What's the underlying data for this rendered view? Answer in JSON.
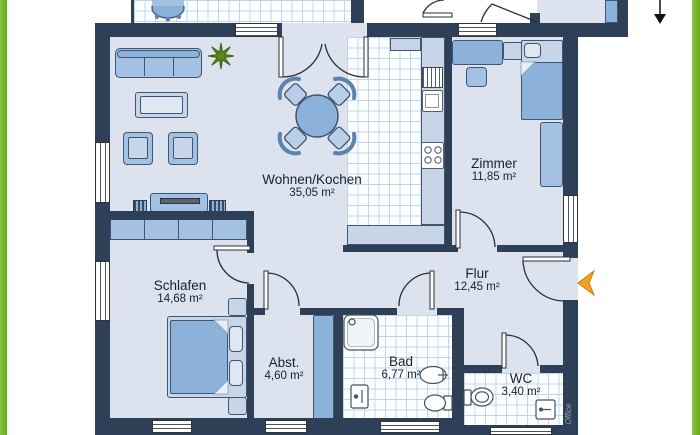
{
  "rooms": [
    {
      "id": "wohnen-kochen",
      "name": "Wohnen/Kochen",
      "area": "35,05 m²"
    },
    {
      "id": "zimmer",
      "name": "Zimmer",
      "area": "11,85 m²"
    },
    {
      "id": "schlafen",
      "name": "Schlafen",
      "area": "14,68 m²"
    },
    {
      "id": "flur",
      "name": "Flur",
      "area": "12,45 m²"
    },
    {
      "id": "abstellraum",
      "name": "Abst.",
      "area": "4,60 m²"
    },
    {
      "id": "bad",
      "name": "Bad",
      "area": "6,77 m²"
    },
    {
      "id": "wc",
      "name": "WC",
      "area": "3,40 m²"
    }
  ],
  "watermark": "Office",
  "colors": {
    "wall": "#2e3f58",
    "floor": "#dce3ee",
    "tile_line": "#bfd6ea",
    "furniture": "#a3c1e2",
    "furniture_dark": "#8cb2da",
    "accent_green": "#76b82a",
    "entrance_arrow": "#f6a21f"
  },
  "icons": [
    "plant-icon",
    "grill-icon",
    "down-arrow-icon",
    "entrance-arrow-icon"
  ]
}
